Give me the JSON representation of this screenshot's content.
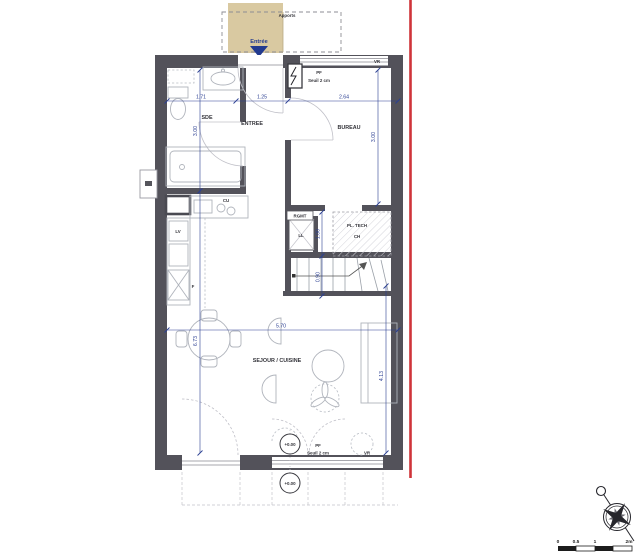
{
  "plan": {
    "porch": {
      "label": "Apports",
      "entrance": "Entrée"
    },
    "rooms": {
      "sde": "SDE",
      "entree": "ENTREE",
      "bureau": "BUREAU",
      "sejour": "SEJOUR / CUISINE",
      "rgmt": "RGMT",
      "pl_tech": "PL. TECH"
    },
    "appliances": {
      "ll": "LL",
      "ch": "CH",
      "cu": "CU",
      "lv": "LV",
      "f": "F"
    },
    "openings": {
      "pf_top": "PF",
      "seuil_top": "Seuil 2 cm",
      "vr_top": "VR",
      "pf_bottom": "PF",
      "seuil_bottom": "Seuil 2 cm",
      "vr_bottom": "VR"
    },
    "levels": {
      "a": "+0.00",
      "b": "+0.00"
    },
    "dims": {
      "w_sde": "1.71",
      "w_entree": "1.25",
      "w_bureau": "2.64",
      "h_sde": "3.00",
      "h_bureau": "3.00",
      "h_rgmt": "1.00",
      "h_stairs": "0.90",
      "w_sejour": "5.70",
      "h_sejour": "6.73",
      "h_right": "4.13"
    },
    "scale_bar": {
      "t0": "0",
      "t05": "0.5",
      "t1": "1",
      "t2": "2m"
    },
    "colors": {
      "wall": "#53525a",
      "porch_tan": "#d9c9a1",
      "property_line": "#cf3339",
      "dimension": "#2b3f92",
      "fixture": "#b0b4bc"
    }
  }
}
